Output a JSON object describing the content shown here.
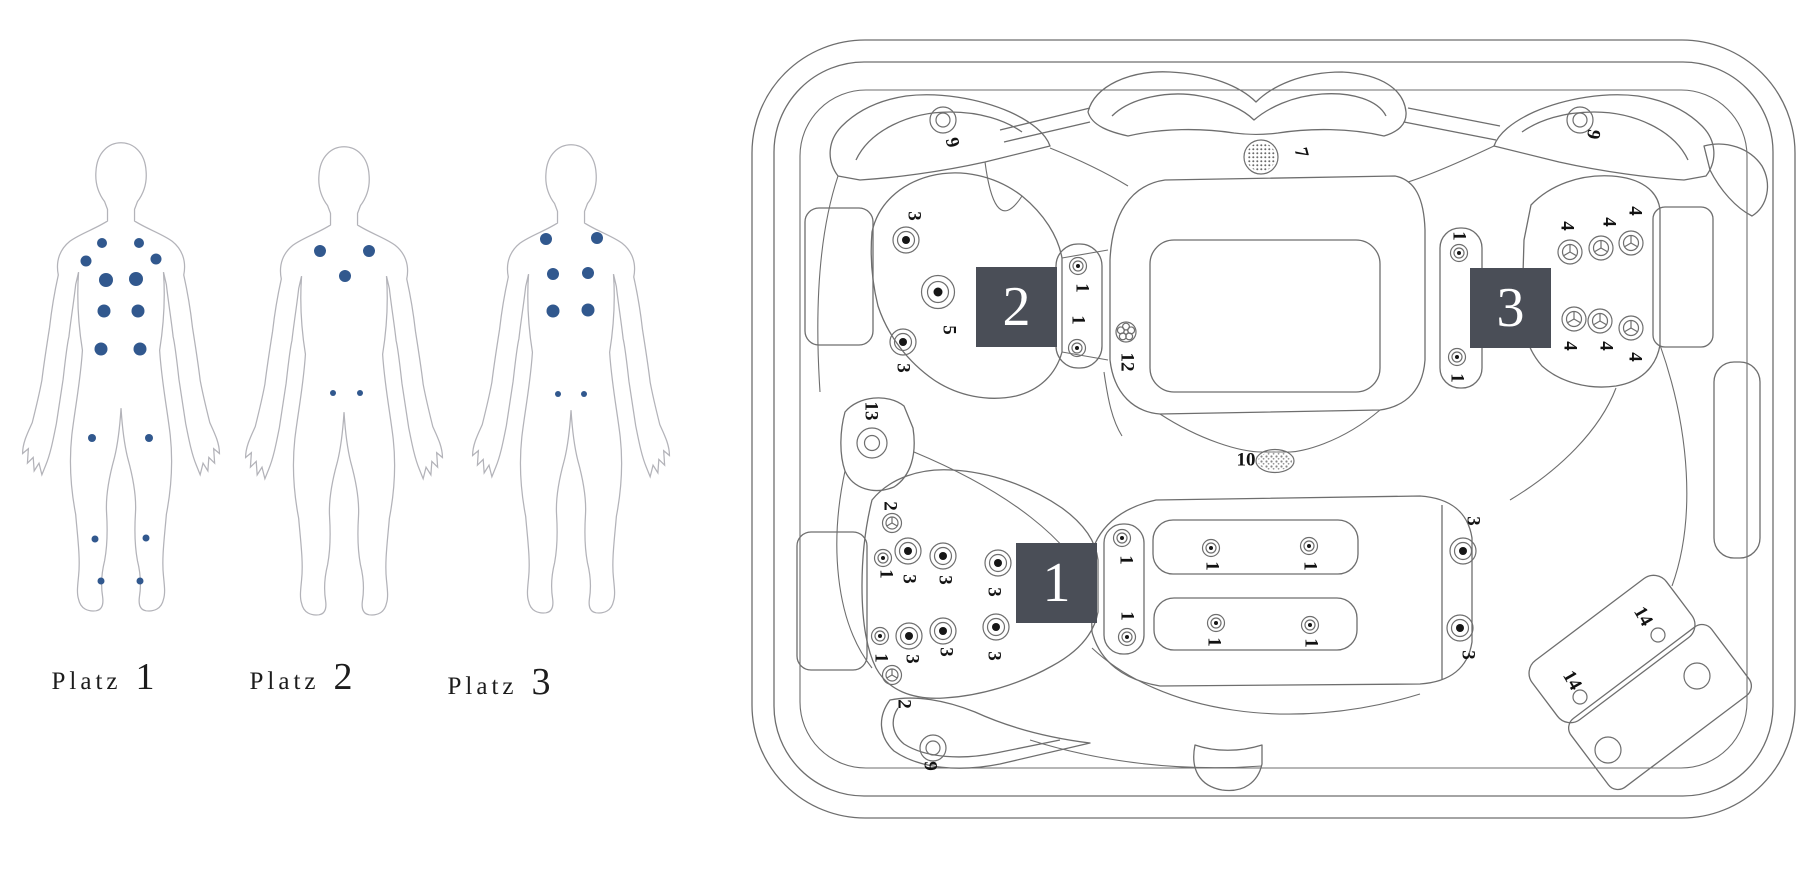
{
  "diagram_title": "Spa seat and jet layout",
  "colors": {
    "dot": "#31588e",
    "seat_box": "#4a4e57",
    "tub_line": "#6e6e6e",
    "body_line": "#b3b3b9",
    "label": "#121212"
  },
  "platz_labels": [
    {
      "word": "Platz",
      "num": "1",
      "x": 103,
      "y": 655
    },
    {
      "word": "Platz",
      "num": "2",
      "x": 301,
      "y": 655
    },
    {
      "word": "Platz",
      "num": "3",
      "x": 499,
      "y": 660
    }
  ],
  "figures": [
    {
      "name": "platz-1-figure",
      "cx": 121,
      "top": 137,
      "dots": [
        [
          102,
          243,
          5
        ],
        [
          139,
          243,
          5
        ],
        [
          86,
          261,
          5.5
        ],
        [
          156,
          259,
          5.5
        ],
        [
          106,
          280,
          7
        ],
        [
          136,
          279,
          7
        ],
        [
          104,
          311,
          6.5
        ],
        [
          138,
          311,
          6.5
        ],
        [
          101,
          349,
          6.5
        ],
        [
          140,
          349,
          6.5
        ],
        [
          92,
          438,
          4
        ],
        [
          149,
          438,
          4
        ],
        [
          95,
          539,
          3.5
        ],
        [
          146,
          538,
          3.5
        ],
        [
          101,
          581,
          3.5
        ],
        [
          140,
          581,
          3.5
        ]
      ]
    },
    {
      "name": "platz-2-figure",
      "cx": 344,
      "top": 141,
      "dots": [
        [
          320,
          251,
          6
        ],
        [
          369,
          251,
          6
        ],
        [
          345,
          276,
          6
        ],
        [
          333,
          393,
          3
        ],
        [
          360,
          393,
          3
        ]
      ]
    },
    {
      "name": "platz-3-figure",
      "cx": 571,
      "top": 139,
      "dots": [
        [
          546,
          239,
          6
        ],
        [
          597,
          238,
          6
        ],
        [
          553,
          274,
          6
        ],
        [
          588,
          273,
          6
        ],
        [
          553,
          311,
          6.5
        ],
        [
          588,
          310,
          6.5
        ],
        [
          558,
          394,
          3
        ],
        [
          584,
          394,
          3
        ]
      ]
    }
  ],
  "seats": [
    {
      "num": "1",
      "x": 1016,
      "y": 543,
      "w": 81,
      "h": 80
    },
    {
      "num": "2",
      "x": 976,
      "y": 267,
      "w": 81,
      "h": 80
    },
    {
      "num": "3",
      "x": 1470,
      "y": 268,
      "w": 81,
      "h": 80
    }
  ],
  "jets": [
    {
      "t": "ring",
      "x": 943,
      "y": 120,
      "label": "9",
      "lx": 951,
      "ly": 143,
      "rot": 75
    },
    {
      "t": "mesh",
      "x": 1261,
      "y": 157,
      "label": "7",
      "lx": 1300,
      "ly": 153,
      "rot": 75
    },
    {
      "t": "ring",
      "x": 1580,
      "y": 120,
      "label": "9",
      "lx": 1592,
      "ly": 134,
      "rot": 100
    },
    {
      "t": "med",
      "x": 906,
      "y": 240,
      "label": "3",
      "lx": 913,
      "ly": 216,
      "rot": 90
    },
    {
      "t": "large",
      "x": 938,
      "y": 292,
      "label": "5",
      "lx": 948,
      "ly": 330,
      "rot": 90
    },
    {
      "t": "med",
      "x": 903,
      "y": 342,
      "label": "3",
      "lx": 902,
      "ly": 368,
      "rot": 90
    },
    {
      "t": "small",
      "x": 1078,
      "y": 266,
      "label": "1",
      "lx": 1081,
      "ly": 288,
      "rot": 90
    },
    {
      "t": "small",
      "x": 1077,
      "y": 348,
      "label": "1",
      "lx": 1077,
      "ly": 320,
      "rot": 90
    },
    {
      "t": "small",
      "x": 1459,
      "y": 253,
      "label": "1",
      "lx": 1458,
      "ly": 236,
      "rot": 90
    },
    {
      "t": "small",
      "x": 1457,
      "y": 357,
      "label": "1",
      "lx": 1456,
      "ly": 378,
      "rot": 90
    },
    {
      "t": "tri",
      "x": 1570,
      "y": 252,
      "label": "4",
      "lx": 1566,
      "ly": 226,
      "rot": 90
    },
    {
      "t": "tri",
      "x": 1601,
      "y": 248,
      "label": "4",
      "lx": 1608,
      "ly": 222,
      "rot": 90
    },
    {
      "t": "tri",
      "x": 1631,
      "y": 243,
      "label": "4",
      "lx": 1634,
      "ly": 211,
      "rot": 90
    },
    {
      "t": "tri",
      "x": 1574,
      "y": 319,
      "label": "4",
      "lx": 1569,
      "ly": 346,
      "rot": 90
    },
    {
      "t": "tri",
      "x": 1600,
      "y": 321,
      "label": "4",
      "lx": 1605,
      "ly": 346,
      "rot": 90
    },
    {
      "t": "tri",
      "x": 1631,
      "y": 328,
      "label": "4",
      "lx": 1634,
      "ly": 357,
      "rot": 90
    },
    {
      "t": "flower",
      "x": 1126,
      "y": 332,
      "label": "12",
      "lx": 1126,
      "ly": 362,
      "rot": 90
    },
    {
      "t": "disc",
      "x": 872,
      "y": 443,
      "label": "13",
      "lx": 870,
      "ly": 411,
      "rot": 90
    },
    {
      "t": "ovaldots",
      "x": 1275,
      "y": 461,
      "label": "10",
      "lx": 1246,
      "ly": 461,
      "rot": 0
    },
    {
      "t": "trism",
      "x": 892,
      "y": 523,
      "label": "2",
      "lx": 889,
      "ly": 506,
      "rot": 90
    },
    {
      "t": "small",
      "x": 883,
      "y": 558,
      "label": "1",
      "lx": 885,
      "ly": 574,
      "rot": 90
    },
    {
      "t": "med",
      "x": 908,
      "y": 551,
      "label": "3",
      "lx": 908,
      "ly": 579,
      "rot": 90
    },
    {
      "t": "med",
      "x": 943,
      "y": 556,
      "label": "3",
      "lx": 944,
      "ly": 580,
      "rot": 90
    },
    {
      "t": "med",
      "x": 998,
      "y": 563,
      "label": "3",
      "lx": 993,
      "ly": 592,
      "rot": 90
    },
    {
      "t": "small",
      "x": 880,
      "y": 636,
      "label": "1",
      "lx": 880,
      "ly": 658,
      "rot": 90
    },
    {
      "t": "med",
      "x": 909,
      "y": 636,
      "label": "3",
      "lx": 911,
      "ly": 659,
      "rot": 90
    },
    {
      "t": "med",
      "x": 943,
      "y": 631,
      "label": "3",
      "lx": 945,
      "ly": 652,
      "rot": 90
    },
    {
      "t": "med",
      "x": 996,
      "y": 627,
      "label": "3",
      "lx": 993,
      "ly": 656,
      "rot": 90
    },
    {
      "t": "trism",
      "x": 892,
      "y": 675,
      "label": "2",
      "lx": 903,
      "ly": 704,
      "rot": 90
    },
    {
      "t": "ring",
      "x": 933,
      "y": 748,
      "label": "9",
      "lx": 929,
      "ly": 766,
      "rot": 90
    },
    {
      "t": "small",
      "x": 1122,
      "y": 538,
      "label": "1",
      "lx": 1125,
      "ly": 560,
      "rot": 90
    },
    {
      "t": "small",
      "x": 1127,
      "y": 637,
      "label": "1",
      "lx": 1126,
      "ly": 616,
      "rot": 90
    },
    {
      "t": "small",
      "x": 1211,
      "y": 548,
      "label": "1",
      "lx": 1211,
      "ly": 566,
      "rot": 90
    },
    {
      "t": "small",
      "x": 1309,
      "y": 546,
      "label": "1",
      "lx": 1309,
      "ly": 566,
      "rot": 90
    },
    {
      "t": "small",
      "x": 1216,
      "y": 623,
      "label": "1",
      "lx": 1213,
      "ly": 642,
      "rot": 90
    },
    {
      "t": "small",
      "x": 1310,
      "y": 625,
      "label": "1",
      "lx": 1310,
      "ly": 643,
      "rot": 90
    },
    {
      "t": "med",
      "x": 1463,
      "y": 551,
      "label": "3",
      "lx": 1472,
      "ly": 521,
      "rot": 90
    },
    {
      "t": "med",
      "x": 1460,
      "y": 628,
      "label": "3",
      "lx": 1467,
      "ly": 655,
      "rot": 90
    },
    {
      "t": "dot",
      "x": 1658,
      "y": 635,
      "label": "14",
      "lx": 1642,
      "ly": 617,
      "rot": 60
    },
    {
      "t": "dot",
      "x": 1580,
      "y": 697,
      "label": "14",
      "lx": 1571,
      "ly": 681,
      "rot": 60
    },
    {
      "t": "hole",
      "x": 1697,
      "y": 676
    },
    {
      "t": "hole",
      "x": 1608,
      "y": 750
    }
  ]
}
